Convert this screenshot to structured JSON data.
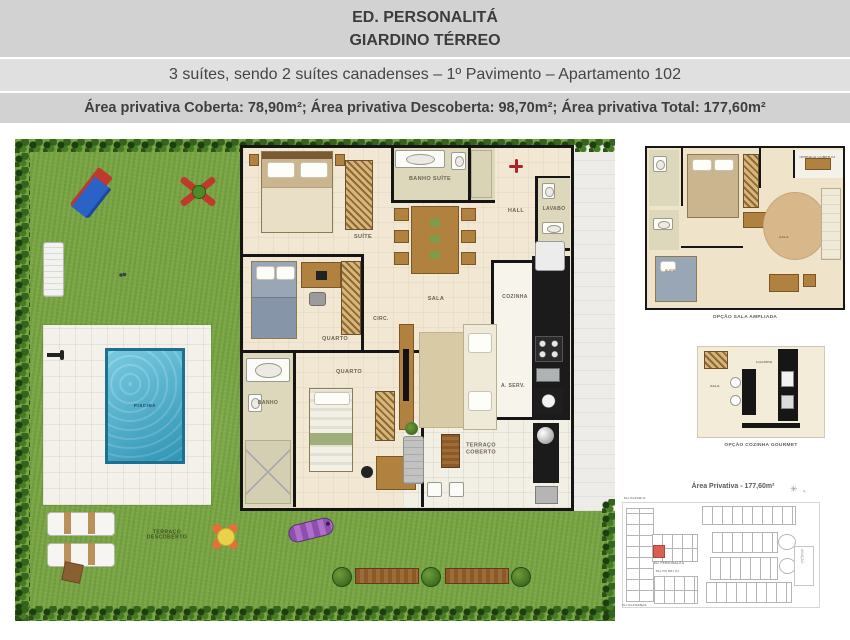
{
  "header": {
    "building": "ED. PERSONALITÁ",
    "plan": "GIARDINO TÉRREO",
    "subtitle": "3 suítes, sendo 2 suítes canadenses – 1º Pavimento – Apartamento 102",
    "areas": "Área privativa Coberta: 78,90m²; Área privativa Descoberta: 98,70m²; Área privativa Total: 177,60m²"
  },
  "rooms": {
    "suite": "SUÍTE",
    "banho_suite": "BANHO SUÍTE",
    "hall": "HALL",
    "lavabo": "LAVABO",
    "sala": "SALA",
    "circ": "CIRC.",
    "quarto": "QUARTO",
    "banho": "BANHO",
    "cozinha": "COZINHA",
    "a_serv": "A. SERV.",
    "terraco_coberto": "TERRAÇO COBERTO"
  },
  "garden": {
    "piscina": "PISCINA",
    "terraco_descoberto": "TERRAÇO DESCOBERTO"
  },
  "options": {
    "sala_ampliada": {
      "caption": "OPÇÃO SALA AMPLIADA",
      "sala": "SALA",
      "suite": "SUÍTE",
      "terraco": "TERRAÇO COBERTO"
    },
    "cozinha_gourmet": {
      "caption": "OPÇÃO COZINHA GOURMET",
      "sala": "SALA",
      "cozinha": "COZINHA"
    }
  },
  "keyplan": {
    "title": "Área Privativa - 177,60m²",
    "buildings": {
      "elevato": "ED. ELEVATO",
      "personalita": "ED. PERSONALITÁ",
      "ritratto": "ED. RITRATTO",
      "eleganza": "ED. ELEGANZA"
    },
    "side_label": "AVIAÇÃO",
    "compass_letter": "N",
    "highlight_color": "#d95f52"
  }
}
